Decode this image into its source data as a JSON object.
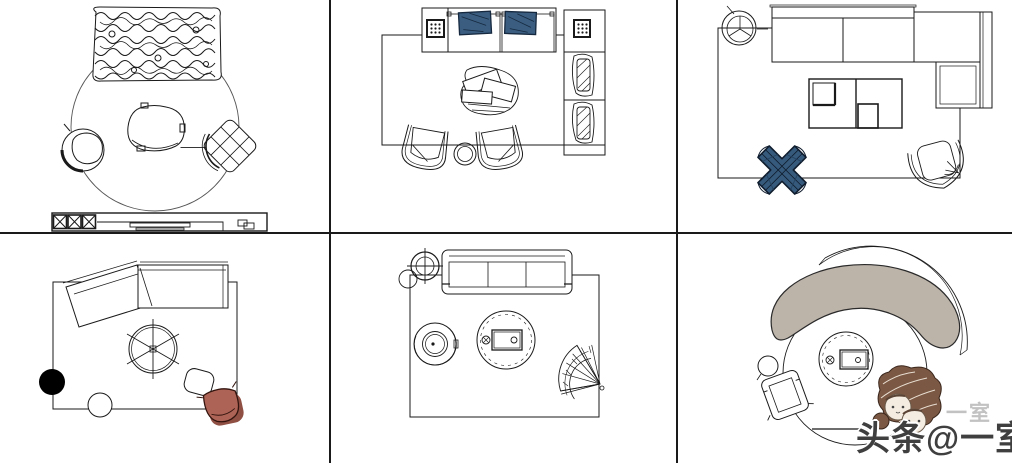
{
  "watermark": {
    "main": "头条@一室",
    "ghost": "一室"
  },
  "grid": {
    "rows": 2,
    "cols": 3,
    "line_color": "#1a1a1a"
  },
  "colors": {
    "line": "#1a1a1a",
    "cushion_blue": "#3a5d80",
    "cushion_blue_dark": "#16293f",
    "knot_blue": "#365a7c",
    "knot_blue_dark": "#101d2e",
    "terracotta": "#ad6355",
    "terracotta_shadow": "#8f4f43",
    "sofa_taupe": "#bcb3a9",
    "pouf_black": "#000000",
    "hair_brown": "#7b5843",
    "face_cream": "#f4ece1",
    "watermark_dark": "#3f3f3f",
    "watermark_light": "#c2c2c2"
  },
  "cells": [
    {
      "id": "round-rug-knit-sofa-set",
      "items": [
        "chunky-knit-sofa",
        "round-rug",
        "triangular-coffee-table",
        "swivel-armchair",
        "quilted-pouf-chair",
        "tv-cabinet"
      ]
    },
    {
      "id": "platform-sofa-set-blue-cushions",
      "items": [
        "area-rug",
        "platform-sofa",
        "blue-cushions",
        "dotted-side-tables",
        "storage-column-with-loungers",
        "magazine-coffee-table",
        "two-armchairs",
        "round-side-table"
      ]
    },
    {
      "id": "l-shaped-sectional-set",
      "items": [
        "area-rug",
        "l-shaped-sofa",
        "potted-plant",
        "panel-coffee-table",
        "knot-pouf",
        "round-armchair"
      ]
    },
    {
      "id": "angled-sectional-set",
      "items": [
        "area-rug",
        "angled-sectional-sofa",
        "spoke-round-table",
        "black-pouf",
        "white-pouf",
        "square-stool",
        "terracotta-armchair"
      ]
    },
    {
      "id": "three-seat-sofa-set",
      "items": [
        "area-rug",
        "three-seat-sofa",
        "potted-plant",
        "round-armchair",
        "round-coffee-table",
        "fan-pouf"
      ]
    },
    {
      "id": "curved-sofa-round-rug-set",
      "items": [
        "round-rug",
        "curved-taupe-sofa",
        "round-coffee-table",
        "square-armchair",
        "round-side-table",
        "cartoon-mascot"
      ]
    }
  ]
}
